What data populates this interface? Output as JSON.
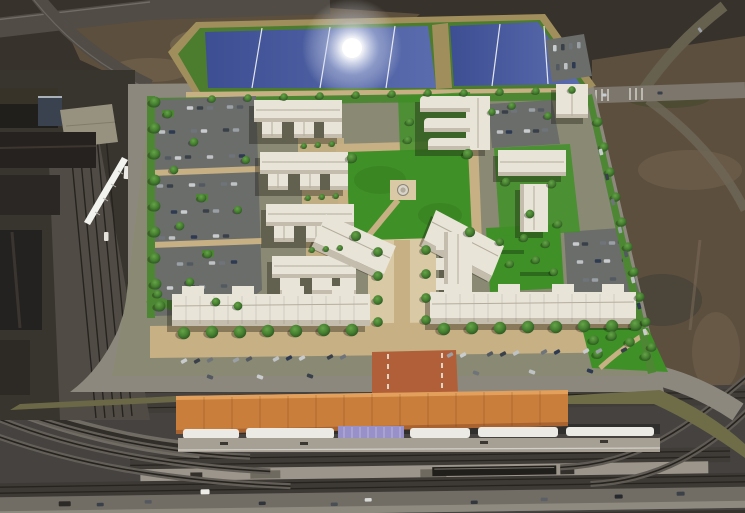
{
  "meta": {
    "title": "Aerial architectural rendering of a transit-oriented development master plan",
    "description": "Bird's-eye rendering: white residential blocks around a central green courtyard with gazebo, surface parking lots with cars, tree-lined streets, a blue detention pond with sun glare at top, dark industrial buildings and a white passenger train at left, and a rail corridor at bottom with an orange-roofed station platform, white canopies, a lavender shelter and an orange crosswalk.",
    "visible_text": []
  },
  "palette": {
    "terrain_dark": "#37322c",
    "dirt_mid": "#5c4f3e",
    "dirt_light": "#75654f",
    "road_light": "#8d887e",
    "road_dark": "#514c45",
    "pond_bank": "#a08f5c",
    "pond_rim_green": "#4c7c2e",
    "pond_water": "#41549b",
    "pond_water_light": "#5a6cae",
    "lawn": "#3f9027",
    "verge_green": "#4e8733",
    "parking": "#6a6d6a",
    "path_tan": "#c7b084",
    "path_light": "#d9c9a4",
    "building_roof": "#e8e4d8",
    "building_face": "#f4f1ea",
    "building_shade": "#c4bdad",
    "building_line": "#b5ad9c",
    "tree_dark": "#2f5c24",
    "tree_light": "#66a348",
    "canopy_orange": "#c97e3c",
    "canopy_orange_dark": "#a96330",
    "crosswalk_orange": "#b05f38",
    "shelter_lavender": "#9790c9",
    "canopy_white": "#eceae4",
    "platform_gray": "#a59f94",
    "track_dark": "#26231f",
    "train_white": "#f2f2ee",
    "sun_glare": "#ffffff"
  },
  "scene": {
    "regions": [
      {
        "name": "detention-pond",
        "label": "blue pond with sun glare, two cells, white lane lines"
      },
      {
        "name": "residential-blocks",
        "label": "white sawtooth apartment rows"
      },
      {
        "name": "central-courtyard",
        "label": "green lawn with gazebo"
      },
      {
        "name": "parking-lots",
        "label": "asphalt lots with parked cars and tree islands"
      },
      {
        "name": "transit-station",
        "label": "orange tile canopy, white canopies, lavender shelter"
      },
      {
        "name": "rail-corridor",
        "label": "multiple tracks, platforms, service road"
      },
      {
        "name": "industrial-area",
        "label": "dark warehouses and rail sidings with white train"
      },
      {
        "name": "streets",
        "label": "tree-lined perimeter streets with angled parking"
      }
    ],
    "counts": {
      "pond_cells": 2,
      "pond_lane_lines": 5,
      "building_rows_west": 4,
      "gazebos": 1,
      "station_canopy_segments": 5,
      "lavender_shelters": 1,
      "trains": 2
    }
  }
}
